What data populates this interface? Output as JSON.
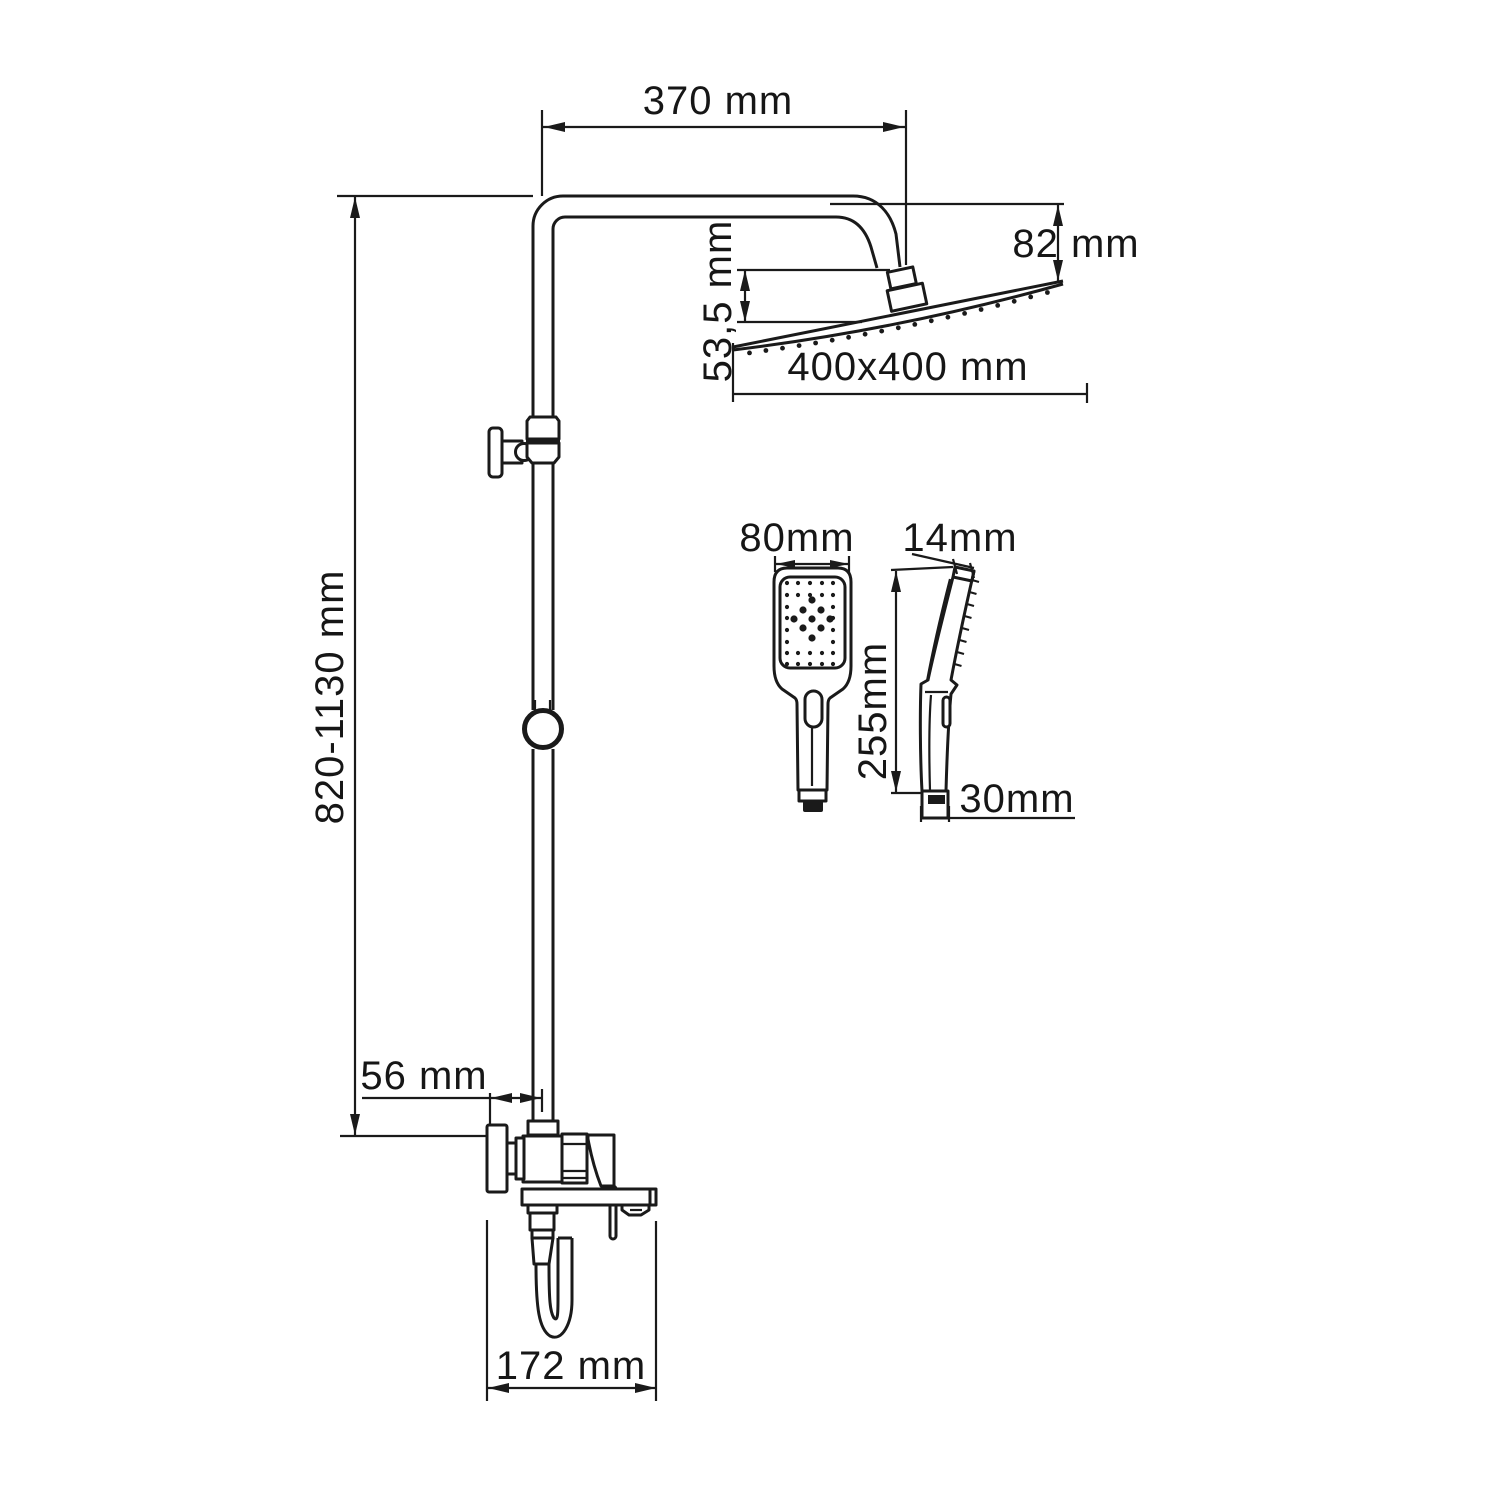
{
  "drawing": {
    "kind": "shower-system-technical-drawing",
    "colors": {
      "line": "#1a1a1a",
      "background": "#ffffff"
    }
  },
  "dimensions": {
    "arm_reach": "370 mm",
    "head_drop": "82 mm",
    "head_offset": "53,5 mm",
    "head_size": "400x400 mm",
    "column_height": "820-1130 mm",
    "wall_offset": "56 mm",
    "spout_span": "172 mm",
    "handshower_width": "80mm",
    "handshower_top_thickness": "14mm",
    "handshower_length": "255mm",
    "handshower_inlet_width": "30mm"
  }
}
